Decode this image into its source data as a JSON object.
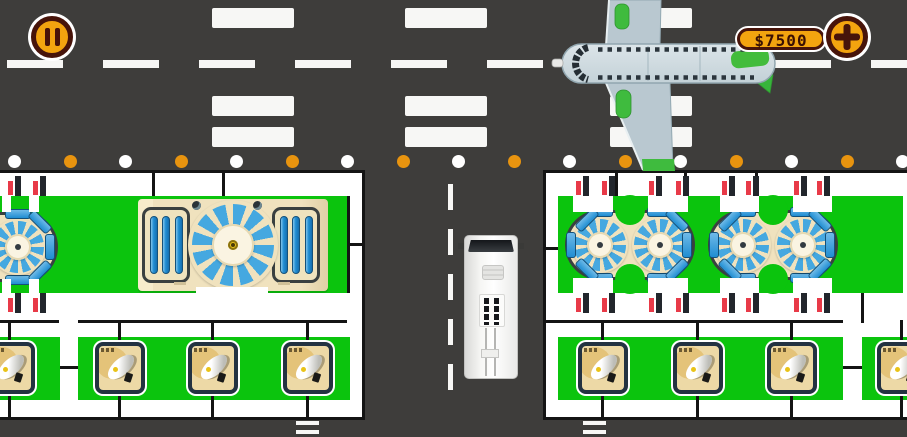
{
  "hud": {
    "money": "$7500",
    "pause_icon": "pause",
    "plus_icon": "plus"
  },
  "palette": {
    "road": "#3E3D3B",
    "mark": "#F7F7F5",
    "white": "#FFFFFF",
    "black": "#141414",
    "green": "#0BC40D",
    "cream": "#F0E2BE",
    "panel_border": "#3A4040",
    "wedge": "#45A8E0",
    "navy": "#233241",
    "tan": "#EDD9A6",
    "tan_circle": "#E4C379",
    "flag_red": "#E83A48",
    "flag_black": "#22262C",
    "dot_orange": "#E8940F",
    "yellow": "#E9C318",
    "orange": "#F3A40F",
    "brown": "#47140A",
    "plane_body": "#CBD7DC",
    "plane_green": "#3FBB3E"
  },
  "scene": {
    "road": {
      "top_dash": {
        "x": 7,
        "y": 60,
        "w": 900,
        "h": 8,
        "dash": 56,
        "gap": 40
      },
      "v_dash": {
        "x": 448,
        "y": 184,
        "w": 5,
        "h": 206,
        "dash": 26,
        "gap": 19
      },
      "crosswalk": {
        "cols": [
          212,
          405,
          610
        ],
        "rows": [
          8,
          96,
          127
        ],
        "w": 82,
        "h": 20
      },
      "edge_dots": {
        "start_x": 8,
        "step": 55.5,
        "count": 17,
        "y": 155,
        "size": 13
      },
      "stop_marks": {
        "xs": [
          296,
          583
        ],
        "y": 421,
        "w": 23,
        "h": 4,
        "gap": 5
      }
    },
    "rects": [
      [
        0,
        170,
        365,
        250,
        "white"
      ],
      [
        0,
        196,
        347,
        97,
        "green"
      ],
      [
        0,
        337,
        60,
        63,
        "green"
      ],
      [
        78,
        337,
        272,
        63,
        "green"
      ],
      [
        0,
        170,
        365,
        3,
        "black"
      ],
      [
        0,
        417,
        365,
        3,
        "black"
      ],
      [
        362,
        170,
        3,
        250,
        "black"
      ],
      [
        347,
        196,
        3,
        97,
        "black"
      ],
      [
        152,
        170,
        3,
        26,
        "black"
      ],
      [
        222,
        170,
        3,
        26,
        "black"
      ],
      [
        350,
        243,
        15,
        3,
        "black"
      ],
      [
        0,
        320,
        59,
        3,
        "black"
      ],
      [
        78,
        320,
        269,
        3,
        "black"
      ],
      [
        60,
        366,
        18,
        3,
        "black"
      ],
      [
        8,
        320,
        3,
        22,
        "black"
      ],
      [
        118,
        320,
        3,
        22,
        "black"
      ],
      [
        211,
        320,
        3,
        22,
        "black"
      ],
      [
        306,
        320,
        3,
        22,
        "black"
      ],
      [
        8,
        394,
        3,
        23,
        "black"
      ],
      [
        118,
        394,
        3,
        23,
        "black"
      ],
      [
        211,
        394,
        3,
        23,
        "black"
      ],
      [
        306,
        394,
        3,
        23,
        "black"
      ],
      [
        543,
        170,
        364,
        250,
        "white"
      ],
      [
        558,
        196,
        345,
        97,
        "green"
      ],
      [
        558,
        337,
        285,
        63,
        "green"
      ],
      [
        862,
        337,
        45,
        63,
        "green"
      ],
      [
        543,
        170,
        364,
        3,
        "black"
      ],
      [
        543,
        417,
        364,
        3,
        "black"
      ],
      [
        543,
        170,
        3,
        250,
        "black"
      ],
      [
        546,
        247,
        12,
        3,
        "black"
      ],
      [
        615,
        170,
        3,
        26,
        "black"
      ],
      [
        684,
        170,
        3,
        26,
        "black"
      ],
      [
        755,
        170,
        3,
        26,
        "black"
      ],
      [
        546,
        320,
        297,
        3,
        "black"
      ],
      [
        861,
        293,
        3,
        30,
        "black"
      ],
      [
        843,
        366,
        19,
        3,
        "black"
      ],
      [
        601,
        320,
        3,
        22,
        "black"
      ],
      [
        696,
        320,
        3,
        22,
        "black"
      ],
      [
        790,
        320,
        3,
        22,
        "black"
      ],
      [
        900,
        320,
        3,
        22,
        "black"
      ],
      [
        601,
        394,
        3,
        23,
        "black"
      ],
      [
        696,
        394,
        3,
        23,
        "black"
      ],
      [
        790,
        394,
        3,
        23,
        "black"
      ],
      [
        900,
        394,
        3,
        23,
        "black"
      ]
    ],
    "tabs": [
      [
        2,
        195,
        9,
        17
      ],
      [
        29,
        195,
        10,
        17
      ],
      [
        2,
        279,
        9,
        17
      ],
      [
        29,
        279,
        10,
        17
      ],
      [
        573,
        194,
        40,
        18
      ],
      [
        648,
        194,
        40,
        18
      ],
      [
        720,
        194,
        39,
        18
      ],
      [
        793,
        194,
        39,
        18
      ],
      [
        573,
        278,
        40,
        18
      ],
      [
        648,
        278,
        40,
        18
      ],
      [
        720,
        278,
        39,
        18
      ],
      [
        793,
        278,
        39,
        18
      ],
      [
        196,
        287,
        72,
        11
      ]
    ],
    "flags": [
      [
        8,
        176
      ],
      [
        33,
        176
      ],
      [
        8,
        293
      ],
      [
        33,
        293
      ],
      [
        576,
        176
      ],
      [
        602,
        176
      ],
      [
        649,
        176
      ],
      [
        676,
        176
      ],
      [
        722,
        176
      ],
      [
        746,
        176
      ],
      [
        794,
        176
      ],
      [
        817,
        176
      ],
      [
        576,
        293
      ],
      [
        602,
        293
      ],
      [
        649,
        293
      ],
      [
        676,
        293
      ],
      [
        722,
        293
      ],
      [
        746,
        293
      ],
      [
        794,
        293
      ],
      [
        817,
        293
      ]
    ],
    "notches": [
      [
        615,
        195
      ],
      [
        615,
        264
      ],
      [
        758,
        195
      ],
      [
        758,
        264
      ]
    ],
    "satellites": [
      [
        -15,
        342
      ],
      [
        95,
        342
      ],
      [
        188,
        342
      ],
      [
        283,
        342
      ],
      [
        578,
        342
      ],
      [
        673,
        342
      ],
      [
        767,
        342
      ],
      [
        877,
        342
      ]
    ],
    "stadiums": [
      {
        "x": 565,
        "y": 210,
        "w": 130,
        "h": 70,
        "fans": [
          35,
          95
        ],
        "caps": [
          "left",
          "right"
        ]
      },
      {
        "x": 708,
        "y": 210,
        "w": 130,
        "h": 70,
        "fans": [
          35,
          95
        ],
        "caps": [
          "left",
          "right"
        ]
      },
      {
        "x": -132,
        "y": 212,
        "w": 190,
        "h": 70,
        "fans": [
          150
        ],
        "caps": [
          "right"
        ]
      }
    ]
  }
}
